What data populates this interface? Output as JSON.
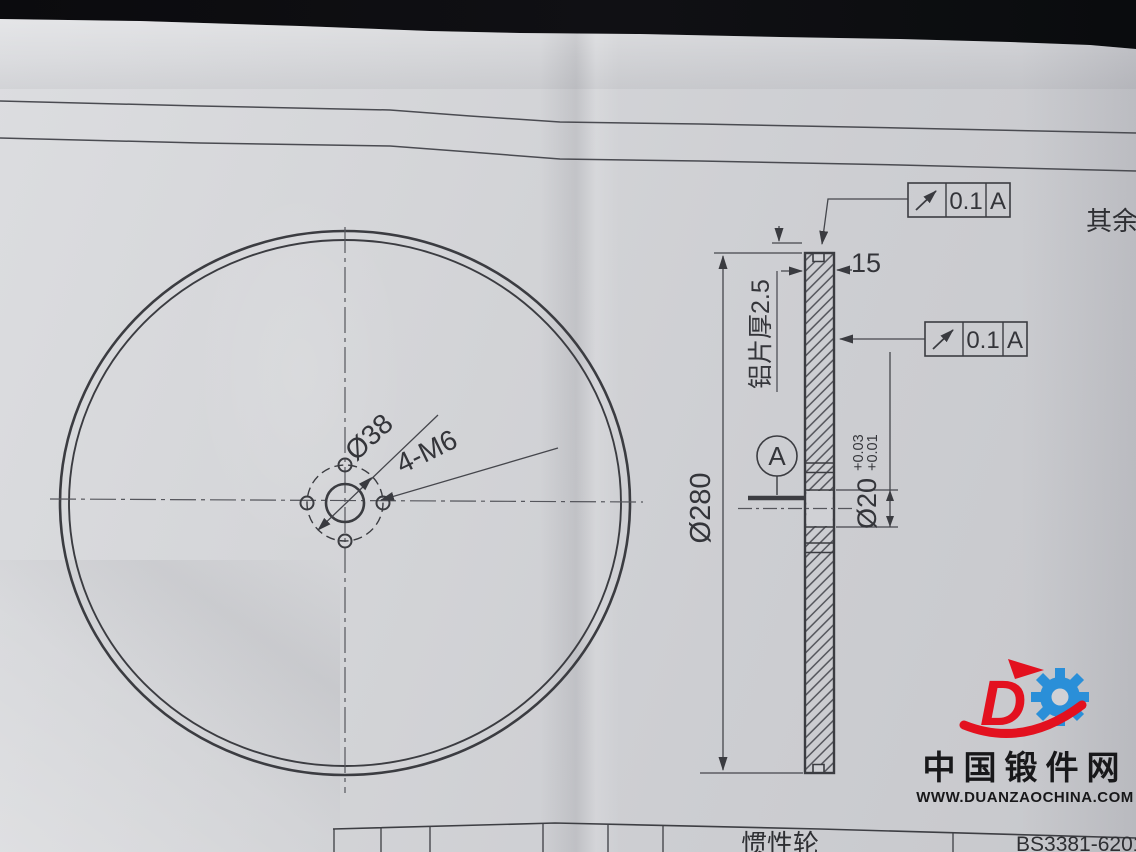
{
  "drawing": {
    "surface_note": "其余",
    "runout_tolerance": "0.1",
    "datum_label": "A",
    "dim_outer_diameter": "Ø280",
    "dim_rim_width": "15",
    "dim_sheet_thickness": "铝片厚2.5",
    "dim_bore": "Ø20",
    "dim_bore_tol_upper": "+0.03",
    "dim_bore_tol_lower": "+0.01",
    "dim_bolt_circle": "Ø38",
    "dim_tapped_holes": "4-M6"
  },
  "title_block": {
    "part_name": "惯性轮",
    "drawing_number": "BS3381-6201"
  },
  "watermark": {
    "site_name": "中国锻件网",
    "site_url": "WWW.DUANZAOCHINA.COM",
    "brand_letter": "D",
    "red": "#e3111f",
    "blue": "#2a8fd8"
  }
}
